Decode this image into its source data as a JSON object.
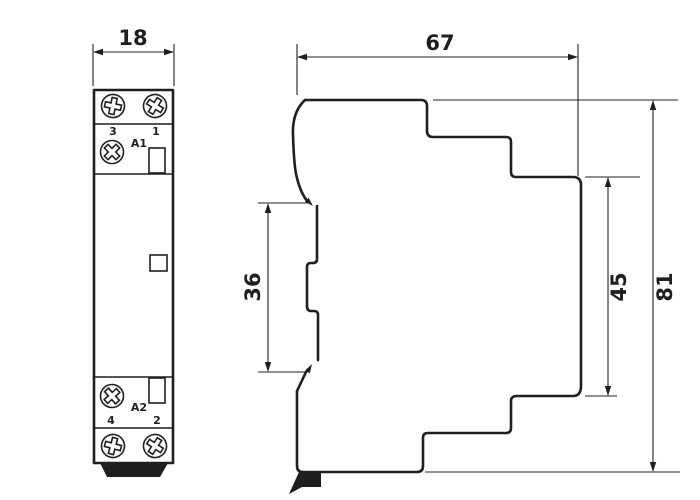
{
  "colors": {
    "line": "#1f1f1d",
    "bg": "#ffffff"
  },
  "front_view": {
    "width_dim": "18",
    "terminals": {
      "top_left": "3",
      "top_right": "1",
      "coil_top": "A1",
      "coil_bottom": "A2",
      "bottom_left": "4",
      "bottom_right": "2"
    }
  },
  "side_view": {
    "depth_dim": "67",
    "height_dim": "81",
    "panel_dim": "45",
    "rail_dim": "36"
  }
}
